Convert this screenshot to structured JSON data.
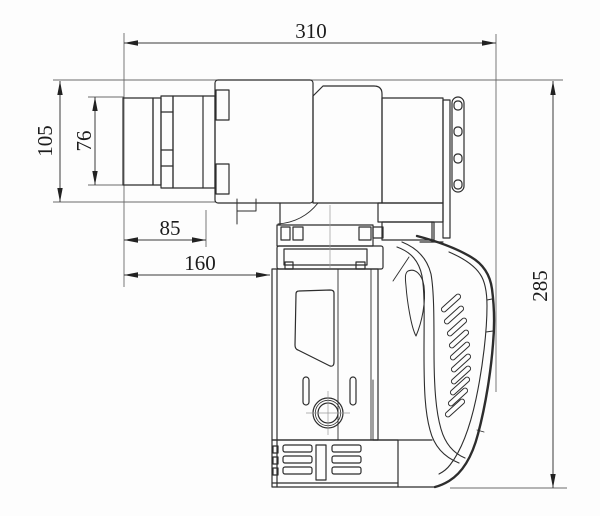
{
  "figure": {
    "type": "technical-dimension-drawing",
    "subject": "angle power torque wrench, side view"
  },
  "dimensions": [
    {
      "name": "overall-length",
      "value": "310",
      "orientation": "horizontal"
    },
    {
      "name": "head-height",
      "value": "105",
      "orientation": "vertical"
    },
    {
      "name": "drive-section-height",
      "value": "76",
      "orientation": "vertical"
    },
    {
      "name": "front-section-length",
      "value": "85",
      "orientation": "horizontal"
    },
    {
      "name": "front-assembly-length",
      "value": "160",
      "orientation": "horizontal"
    },
    {
      "name": "overall-height",
      "value": "285",
      "orientation": "vertical"
    }
  ]
}
